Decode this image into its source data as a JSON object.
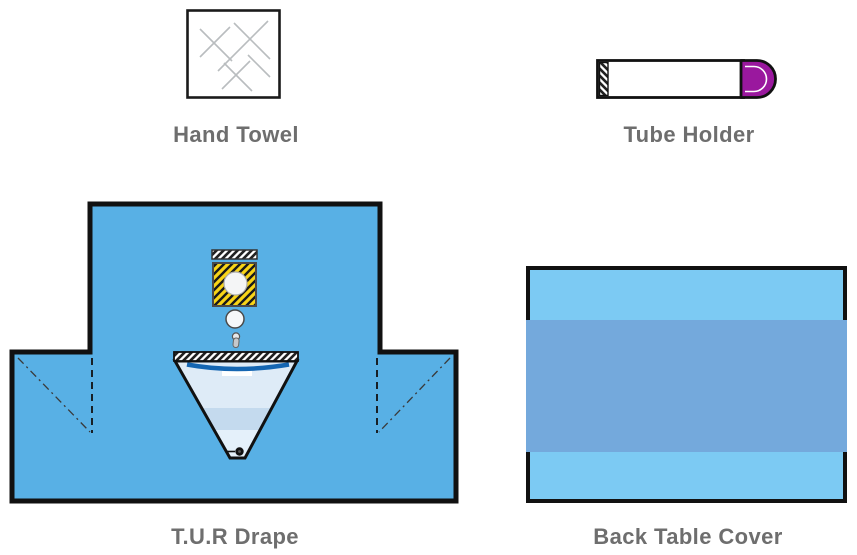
{
  "figure": {
    "title": "Surgical drape pack components",
    "background": "#FFFFFF"
  },
  "products": [
    {
      "id": "hand-towel",
      "label": "Hand Towel",
      "icon": "hand-towel-illustration"
    },
    {
      "id": "tube-holder",
      "label": "Tube Holder",
      "icon": "tube-holder-illustration"
    },
    {
      "id": "tur-drape",
      "label": "T.U.R Drape",
      "icon": "tur-drape-illustration"
    },
    {
      "id": "back-table-cover",
      "label": "Back Table Cover",
      "icon": "back-table-cover-illustration"
    }
  ],
  "colors": {
    "label_text": "#6E6E6E",
    "outline": "#111111",
    "drape_blue": "#58B0E5",
    "table_cover_blue": "#7CCAF3",
    "table_cover_band": "#74A9DC",
    "tube_cap_purple": "#9A189E",
    "aperture_yellow": "#F8D416",
    "pouch_fill": "#DEEBF7",
    "pouch_band": "#C4DAEE",
    "pouch_rim_blue": "#1566B2",
    "towel_line_gray": "#B9BDBF"
  }
}
